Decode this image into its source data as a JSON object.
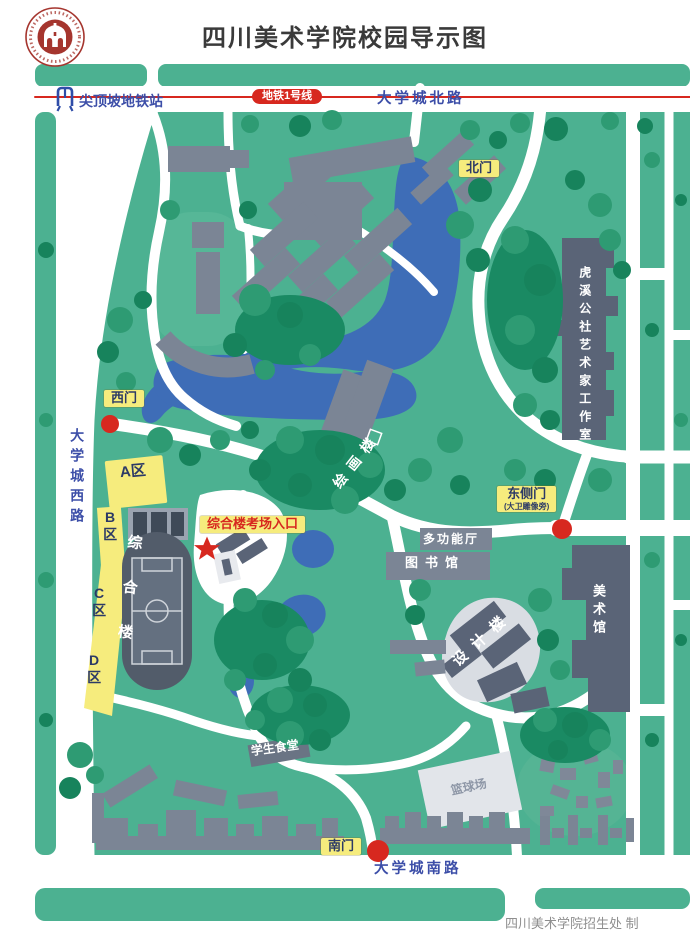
{
  "header": {
    "title": "四川美术学院校园导示图"
  },
  "metro": {
    "station_label": "尖顶坡地铁站",
    "line_badge": "地铁1号线"
  },
  "roads": {
    "north": "大学城北路",
    "west": "大学城西路",
    "south": "大学城南路"
  },
  "gates": {
    "north": "北门",
    "west": "西门",
    "south": "南门",
    "east": "东侧门",
    "east_note": "(大卫雕像旁)"
  },
  "places": {
    "huxi_studio": "虎溪公社艺术家工作室",
    "zone_a": "A区",
    "zone_b": "B区",
    "zone_c": "C区",
    "zone_d": "D区",
    "comprehensive_building": "综合楼",
    "exam_entrance": "综合楼考场入口",
    "multifunction_hall": "多功能厅",
    "library": "图书馆",
    "art_museum": "美术馆",
    "design_building": "设计楼",
    "painting_building": "绘画楼",
    "student_canteen": "学生食堂",
    "basketball_court": "篮球场"
  },
  "footer": {
    "credit": "四川美术学院招生处 制"
  },
  "colors": {
    "campus_green": "#4cb191",
    "tree_green": "#2e9b73",
    "tree_dark": "#17835c",
    "building_gray": "#7b8595",
    "building_dark": "#5a6477",
    "water_blue": "#3e6db7",
    "label_yellow": "#f6ec7d",
    "marker_red": "#d7281f",
    "road_text_blue": "#3c4ea8"
  }
}
